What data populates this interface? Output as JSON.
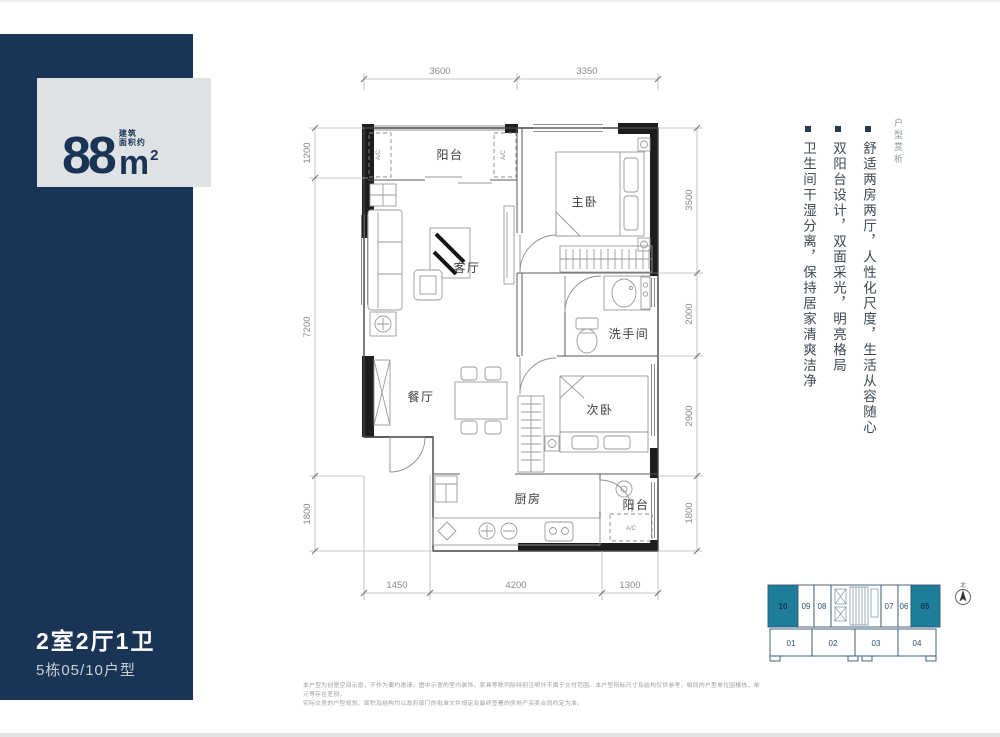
{
  "sidebar": {
    "area_value": "88",
    "area_note_1": "建筑",
    "area_note_2": "面积约",
    "area_unit": "m",
    "area_sup": "2",
    "layout_title": "2室2厅1卫",
    "unit_subtitle": "5栋05/10户型",
    "colors": {
      "navy": "#1a3456",
      "panel": "#dfe2e5"
    }
  },
  "floorplan": {
    "rooms": {
      "balcony_top": "阳台",
      "master": "主卧",
      "living": "客厅",
      "bath": "洗手间",
      "dining": "餐厅",
      "second": "次卧",
      "kitchen": "厨房",
      "balcony_bottom": "阳台"
    },
    "ac_label": "A/C",
    "dims": {
      "top": [
        "3600",
        "3350"
      ],
      "left": [
        "1200",
        "7200",
        "1800"
      ],
      "right": [
        "3500",
        "2000",
        "2900",
        "1800"
      ],
      "bottom": [
        "1450",
        "4200",
        "1300"
      ]
    }
  },
  "features": {
    "section_label": "户型赏析",
    "items": [
      "舒适两房两厅，人性化尺度，生活从容随心",
      "双阳台设计，双面采光，明亮格局",
      "卫生间干湿分离，保持居家清爽洁净"
    ]
  },
  "key_plan": {
    "top_units": [
      "10",
      "09",
      "08",
      "07",
      "06",
      "05"
    ],
    "bottom_units": [
      "01",
      "02",
      "03",
      "04"
    ],
    "highlighted_units": [
      "10",
      "05"
    ],
    "teal": "#1e7e9a",
    "compass_label": "北"
  },
  "disclaimer": {
    "line1": "本户型为创意空间示意，不作为要约邀请，图中示意的室内装饰、家具等陈列除特别注明外不属于交付范围。本户型所标尺寸及结构仅供参考，相同的户型单位因楼栋、单元等存在差别，",
    "line2": "实际交房的户型规划、面积及结构均以政府部门的批准文件规定及最终签署的房地产买卖合同约定为准。"
  }
}
